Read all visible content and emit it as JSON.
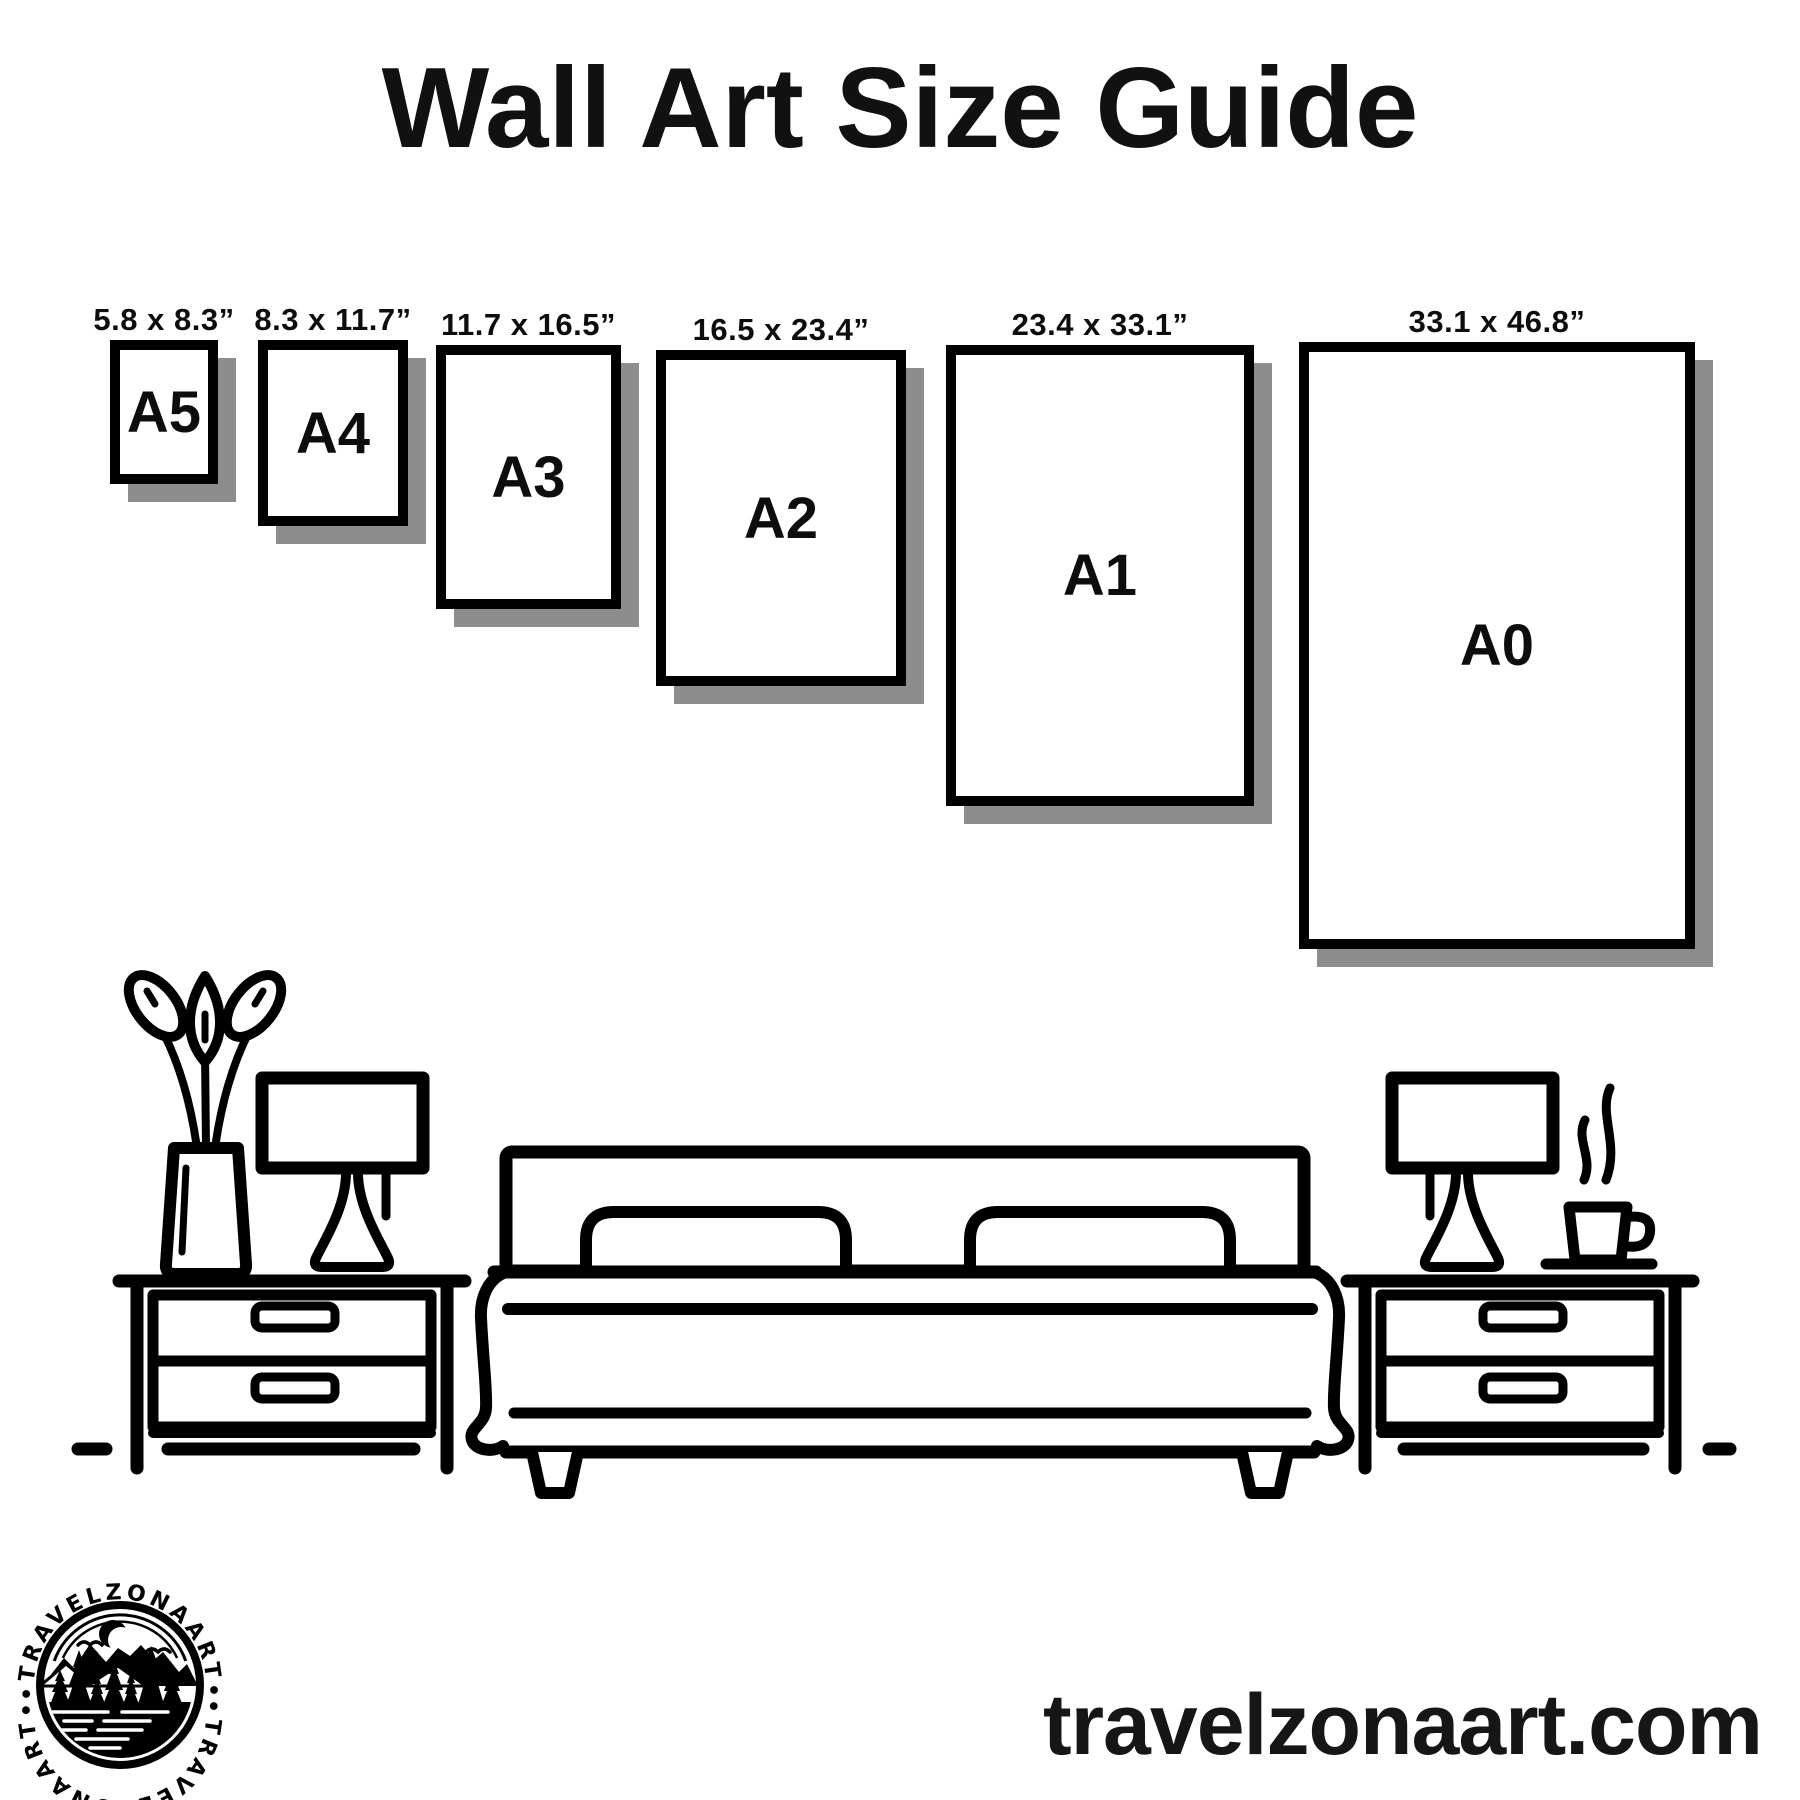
{
  "title": "Wall Art Size Guide",
  "posters": [
    {
      "label": "A5",
      "size": "5.8 x 8.3”"
    },
    {
      "label": "A4",
      "size": "8.3 x 11.7”"
    },
    {
      "label": "A3",
      "size": "11.7 x 16.5”"
    },
    {
      "label": "A2",
      "size": "16.5 x 23.4”"
    },
    {
      "label": "A1",
      "size": "23.4 x 33.1”"
    },
    {
      "label": "A0",
      "size": "33.1 x 46.8”"
    }
  ],
  "logo": {
    "arc_top": "•TRAVELZONAART•",
    "arc_bottom": "•TRAVELZONAART•"
  },
  "footer": {
    "website": "travelzonaart.com"
  },
  "colors": {
    "ink": "#000000",
    "shadow": "#8d8d8d",
    "text": "#111111"
  },
  "scene": {
    "icons": [
      "plant-vase-icon",
      "table-lamp-icon",
      "nightstand-icon",
      "bed-icon",
      "pillow-icon",
      "coffee-cup-icon",
      "steam-icon",
      "floor-line",
      "mountain-badge-logo"
    ]
  }
}
